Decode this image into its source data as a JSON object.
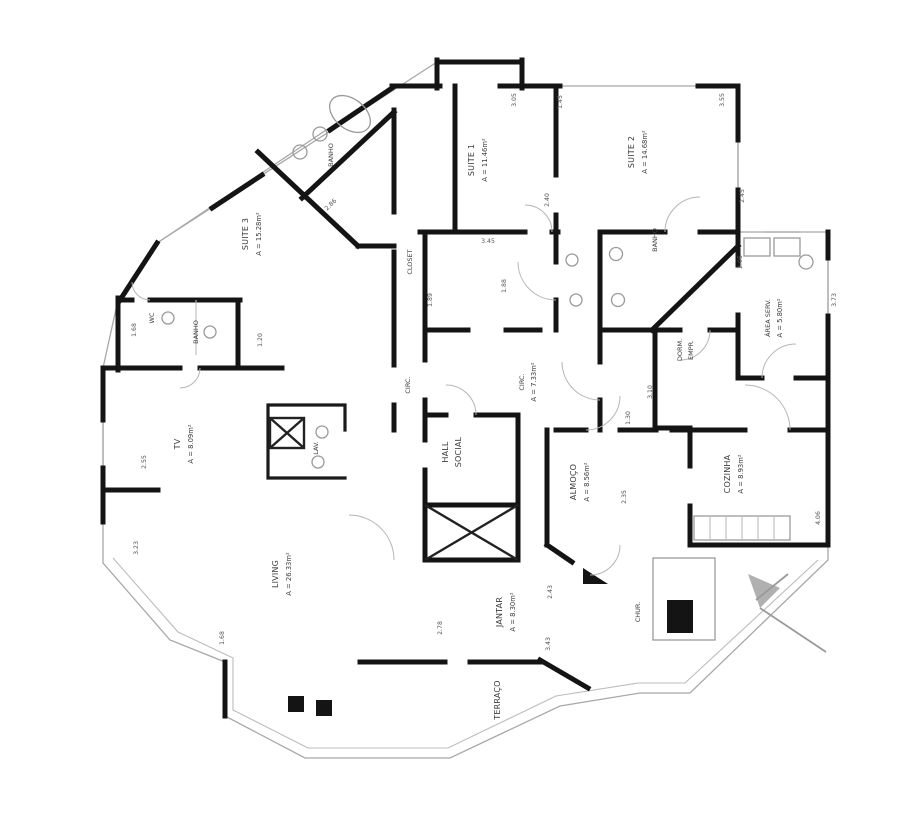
{
  "plan": {
    "type": "apartment-floor-plan",
    "rooms": {
      "suite1": {
        "name": "SUITE 1",
        "area": "A = 11.46m²"
      },
      "suite2": {
        "name": "SUITE 2",
        "area": "A = 14.68m²"
      },
      "suite3": {
        "name": "SUITE 3",
        "area": "A = 15.28m²"
      },
      "tv": {
        "name": "TV",
        "area": "A = 8.09m²"
      },
      "living": {
        "name": "LIVING",
        "area": "A = 26.33m²"
      },
      "jantar": {
        "name": "JANTAR",
        "area": "A = 8.30m²"
      },
      "almoco": {
        "name": "ALMOÇO",
        "area": "A = 8.56m²"
      },
      "cozinha": {
        "name": "COZINHA",
        "area": "A = 8.93m²"
      },
      "area_serv": {
        "name": "ÁREA SERV.",
        "area": "A = 5.80m²"
      },
      "circ_int": {
        "name": "CIRC.",
        "area": "A = 7.33m²"
      },
      "hall": {
        "line1": "HALL",
        "line2": "SOCIAL"
      },
      "dorm_empr": {
        "line1": "DORM.",
        "line2": "EMPR."
      },
      "terraco": {
        "name": "TERRAÇO"
      },
      "chur": {
        "name": "CHUR."
      },
      "closet": {
        "name": "CLOSET"
      },
      "circ": {
        "name": "CIRC."
      },
      "lav": {
        "name": "LAV."
      },
      "banho_top": {
        "name": "BANHO"
      },
      "banho_s2": {
        "name": "BANHO"
      },
      "banho_3": {
        "name": "BANHO"
      },
      "wc": {
        "name": "WC"
      }
    },
    "dims": [
      "3.05",
      "1.45",
      "3.55",
      "2.40",
      "2.45",
      "3.45",
      "1.89",
      "1.88",
      "1.20",
      "1.68",
      "2.55",
      "3.23",
      "1.68",
      "2.78",
      "3.43",
      "2.35",
      "3.10",
      "1.30",
      "2.05",
      "4.06",
      "3.73",
      "2.86",
      "2.43"
    ],
    "colors": {
      "wall": "#141414",
      "thin_line": "#a8a8a8",
      "label": "#3c3c3c",
      "background": "#ffffff"
    }
  }
}
